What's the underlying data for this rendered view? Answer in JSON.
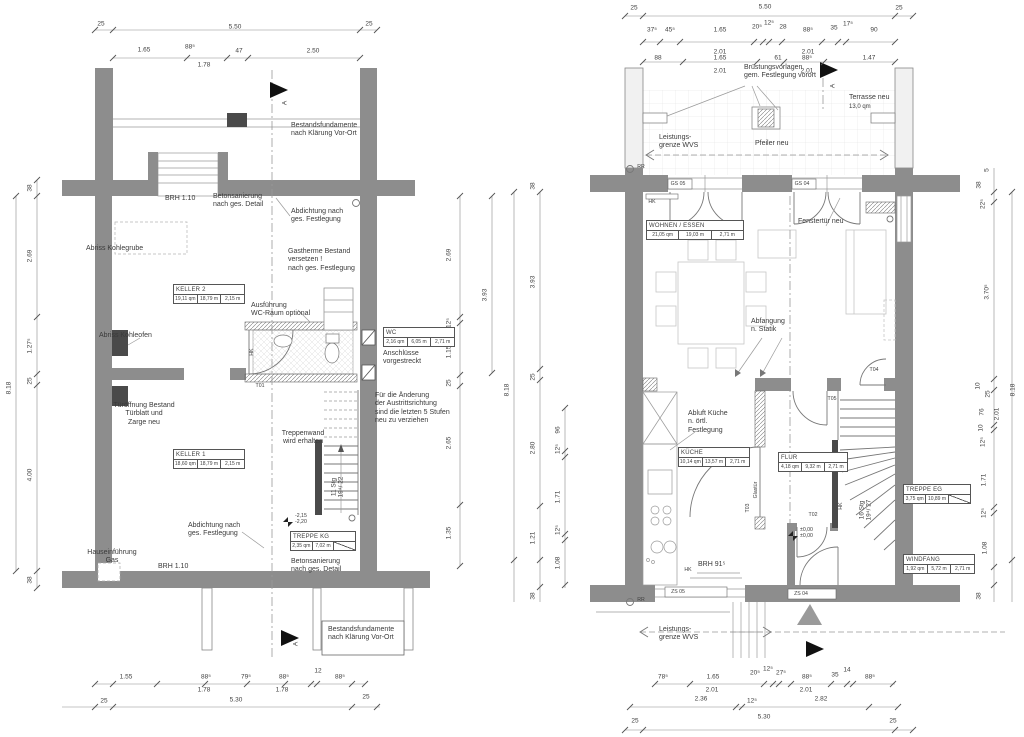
{
  "section": {
    "label": "A"
  },
  "lp": {
    "rooms": {
      "keller2": {
        "name": "KELLER 2",
        "a": "19,11 qm",
        "p": "18,79 m",
        "h": "2,15 m"
      },
      "wc": {
        "name": "WC",
        "a": "2,16 qm",
        "p": "6,05 m",
        "h": "2,71 m"
      },
      "keller1": {
        "name": "KELLER 1",
        "a": "18,60 qm",
        "p": "18,79 m",
        "h": "2,15 m"
      },
      "treppe_kg": {
        "name": "TREPPE KG",
        "a": "2,35 qm",
        "p": "7,02 m"
      }
    },
    "notes": {
      "fund_top": "Bestandsfundamente\nnach Klärung Vor-Ort",
      "brh_top": "BRH 1.10",
      "beton_top": "Betonsanierung\nnach ges. Detail",
      "abdicht_top": "Abdichtung nach\nges. Festlegung",
      "kohlegrube": "Abriss Kohlegrube",
      "gastherme": "Gastherme Bestand\nversetzen !\nnach ges. Festlegung",
      "wc_optional": "Ausführung\nWC-Raum optional",
      "anschluesse": "Anschlüsse\nvorgestreckt",
      "kohleofen": "Abriss Kohleofen",
      "tueroeffnung": "Türöffnung Bestand\nTürblatt und\nZarge neu",
      "stufen": "Für die Änderung\nder Austrittsrichtung\nsind die letzten 5 Stufen\nneu zu verziehen",
      "treppenwand": "Treppenwand\nwird erhalten",
      "stg": "11 Stg\n19⁴/ 22",
      "level": "-2,15\n-2,20",
      "abdicht_bottom": "Abdichtung nach\nges. Festlegung",
      "gas": "Hauseinführung\nGas",
      "brh_bottom": "BRH 1.10",
      "beton_bottom": "Betonsanierung\nnach ges. Detail",
      "fund_bottom": "Bestandsfundamente\nnach Klärung Vor-Ort",
      "t01": "T01",
      "hk": "HK"
    },
    "dims": {
      "t0": [
        "25",
        "5.50",
        "25"
      ],
      "t1": [
        "1.65",
        "88⁵",
        "47",
        "2.50"
      ],
      "t1sub": "1.78",
      "left": [
        "38",
        "2.69",
        "1.27⁵",
        "25",
        "4.00",
        "38"
      ],
      "left_total": "8.18",
      "right": [
        "2.69",
        "12⁵",
        "1.15",
        "25",
        "2.65",
        "1.35"
      ],
      "right_outer": "3.93",
      "b1": [
        "1.55",
        "88⁵",
        "79⁵",
        "88⁵",
        "12",
        "88⁵"
      ],
      "b1sub": [
        "1.78",
        "1.78"
      ],
      "b2": [
        "25",
        "5.30",
        "25"
      ]
    }
  },
  "rp": {
    "rooms": {
      "wohnen": {
        "name": "WOHNEN / ESSEN",
        "a": "21,05 qm",
        "p": "19,03 m",
        "h": "2,71 m"
      },
      "kueche": {
        "name": "KÜCHE",
        "a": "10,14 qm",
        "p": "13,57 m",
        "h": "2,71 m"
      },
      "flur": {
        "name": "FLUR",
        "a": "4,18 qm",
        "p": "9,32 m",
        "h": "2,71 m"
      },
      "treppe_eg": {
        "name": "TREPPE EG",
        "a": "3,75 qm",
        "p": "10,89 m"
      },
      "windfang": {
        "name": "WINDFANG",
        "a": "1,92 qm",
        "p": "5,72 m",
        "h": "2,71 m"
      }
    },
    "notes": {
      "bruestung": "Brüstungsvorlagen\ngem. Festlegung vorort",
      "terrasse": "Terrasse neu",
      "terrasse_qm": "13,0 qm",
      "pfeiler": "Pfeiler neu",
      "lgrenze_top": "Leistungs-\ngrenze WVS",
      "rr": "RR",
      "fenstertuer": "Fenstertür neu",
      "abfangung": "Abfangung\nn. Statik",
      "abluft": "Abluft Küche\nn. örtl.\nFestlegung",
      "glastuer": "Glastür",
      "stg": "16 Stg\n19⁴/ 27",
      "level": "±0,00\n±0,00",
      "brh": "BRH 91⁵",
      "lgrenze_bottom": "Leistungs-\ngrenze WVS",
      "hk": "HK",
      "t02": "T02",
      "t03": "T03",
      "t04": "T04",
      "t05": "T05",
      "gs05": "GS 05",
      "gs04": "GS 04",
      "zs05": "ZS 05",
      "zs04": "ZS 04"
    },
    "dims": {
      "t0": [
        "25",
        "5.50",
        "25"
      ],
      "t1": [
        "37⁵",
        "45⁵",
        "1.65",
        "20⁵",
        "12⁵",
        "28",
        "88⁵",
        "35",
        "17⁵",
        "90"
      ],
      "t1sub": [
        "2.01",
        "2.01"
      ],
      "t2": [
        "88",
        "1.65",
        "61",
        "88⁵",
        "1.47"
      ],
      "t2sub": [
        "2.01",
        "2.01"
      ],
      "left": [
        "38",
        "3.93",
        "25",
        "2.80",
        "1.21",
        "38"
      ],
      "left_total": "8.18",
      "left_inner": [
        "96",
        "12⁵",
        "1.71",
        "12⁵",
        "1.08"
      ],
      "right": [
        "5",
        "38",
        "22⁵",
        "3.70⁵",
        "10",
        "25",
        "76",
        "10",
        "12⁵",
        "1.71",
        "12⁵",
        "1.08",
        "38"
      ],
      "right_sub": "2.01",
      "right_total": "8.18",
      "b1": [
        "78⁵",
        "1.65",
        "20⁵",
        "12⁵",
        "27⁵",
        "88⁵",
        "35",
        "14",
        "88⁵"
      ],
      "b1sub": [
        "2.01",
        "2.01"
      ],
      "b2": [
        "2.36",
        "12⁵",
        "2.82"
      ],
      "b3": [
        "25",
        "5.30",
        "25"
      ]
    }
  }
}
